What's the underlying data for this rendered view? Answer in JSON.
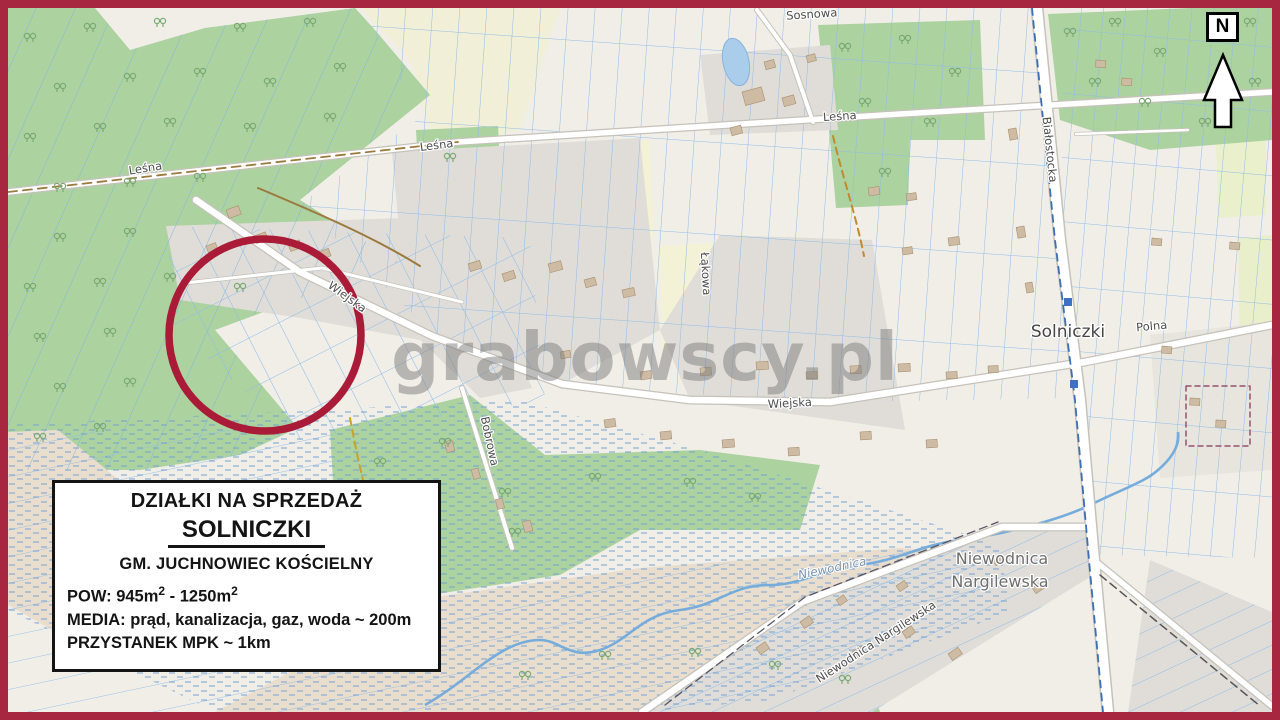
{
  "colors": {
    "frame": "#A72640",
    "highlight_circle": "#AA1B38",
    "forest": "#ACD2A0",
    "parcel_lines": "#8FBCE8",
    "water": "#76ACDB",
    "built_area": "#E0DDD8"
  },
  "watermark": {
    "text": "grabowscy.pl"
  },
  "compass": {
    "label": "N"
  },
  "info_box": {
    "title": "DZIAŁKI NA SPRZEDAŻ",
    "locality": "SOLNICZKI",
    "commune": "GM. JUCHNOWIEC KOŚCIELNY",
    "area_prefix": "POW: 945m",
    "area_sup1": "2",
    "area_mid": " - 1250m",
    "area_sup2": "2",
    "media": "MEDIA: prąd, kanalizacja, gaz, woda ~ 200m",
    "transit": "PRZYSTANEK MPK ~ 1km"
  },
  "map": {
    "labels": {
      "sosnowa": "Sosnowa",
      "lesna": "Leśna",
      "bialostocka": "Białostocka",
      "lakowa": "Łąkowa",
      "wiejska": "Wiejska",
      "polna": "Polna",
      "bobrowa": "Bobrowa",
      "solniczki": "Solniczki",
      "niewodnica_river": "Niewodnica",
      "niewodnica_line1": "Niewodnica",
      "niewodnica_line2": "Nargilewska",
      "niewodnica_street": "Niewodnica Nargilewska"
    }
  }
}
